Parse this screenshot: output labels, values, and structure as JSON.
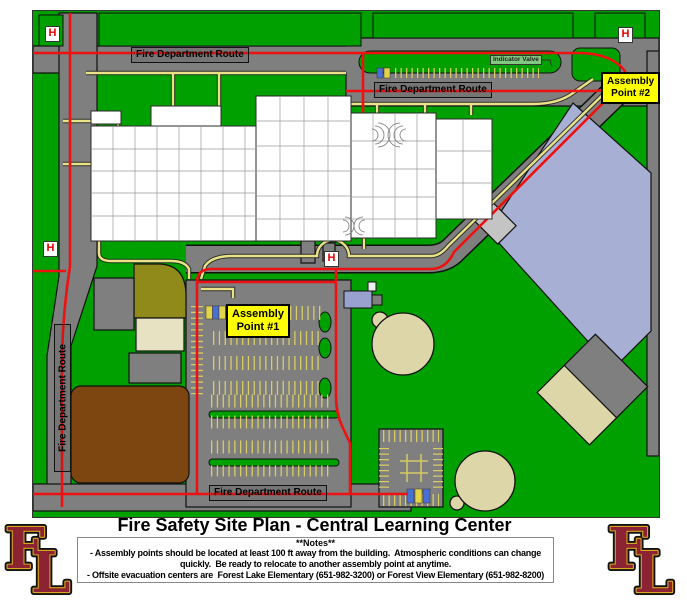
{
  "map": {
    "labels": {
      "fire_route": "Fire Department Route",
      "indicator_valve": "Indicator Valve",
      "hydrant": "H",
      "assembly_point_1": {
        "line1": "Assembly",
        "line2": "Point #1"
      },
      "assembly_point_2": {
        "line1": "Assembly",
        "line2": "Point #2"
      }
    },
    "colors": {
      "grass": "#00A000",
      "road": "#7F7F7F",
      "route_red": "#EE1111",
      "path_yellow": "#EAE286",
      "parking_yellow": "#D8CC66",
      "assembly_yellow": "#FFFF00",
      "field_beige": "#DCD6A8",
      "dome_blue_gray": "#A7B0D4",
      "dirt_brown": "#7D4510",
      "logo_maroon": "#8B2332",
      "logo_gold": "#D9A520"
    }
  },
  "footer": {
    "title": "Fire Safety Site Plan - Central Learning Center",
    "notes_header": "**Notes**",
    "notes_lines": [
      "- Assembly points should be located at least 100 ft away from the building.  Atmospheric conditions can change",
      "quickly.  Be ready to relocate to another assembly point at anytime.",
      "- Offsite evacuation centers are  Forest Lake Elementary (651-982-3200) or Forest View Elementary (651-982-8200)"
    ],
    "logo": {
      "letter_f": "F",
      "letter_l": "L"
    }
  }
}
